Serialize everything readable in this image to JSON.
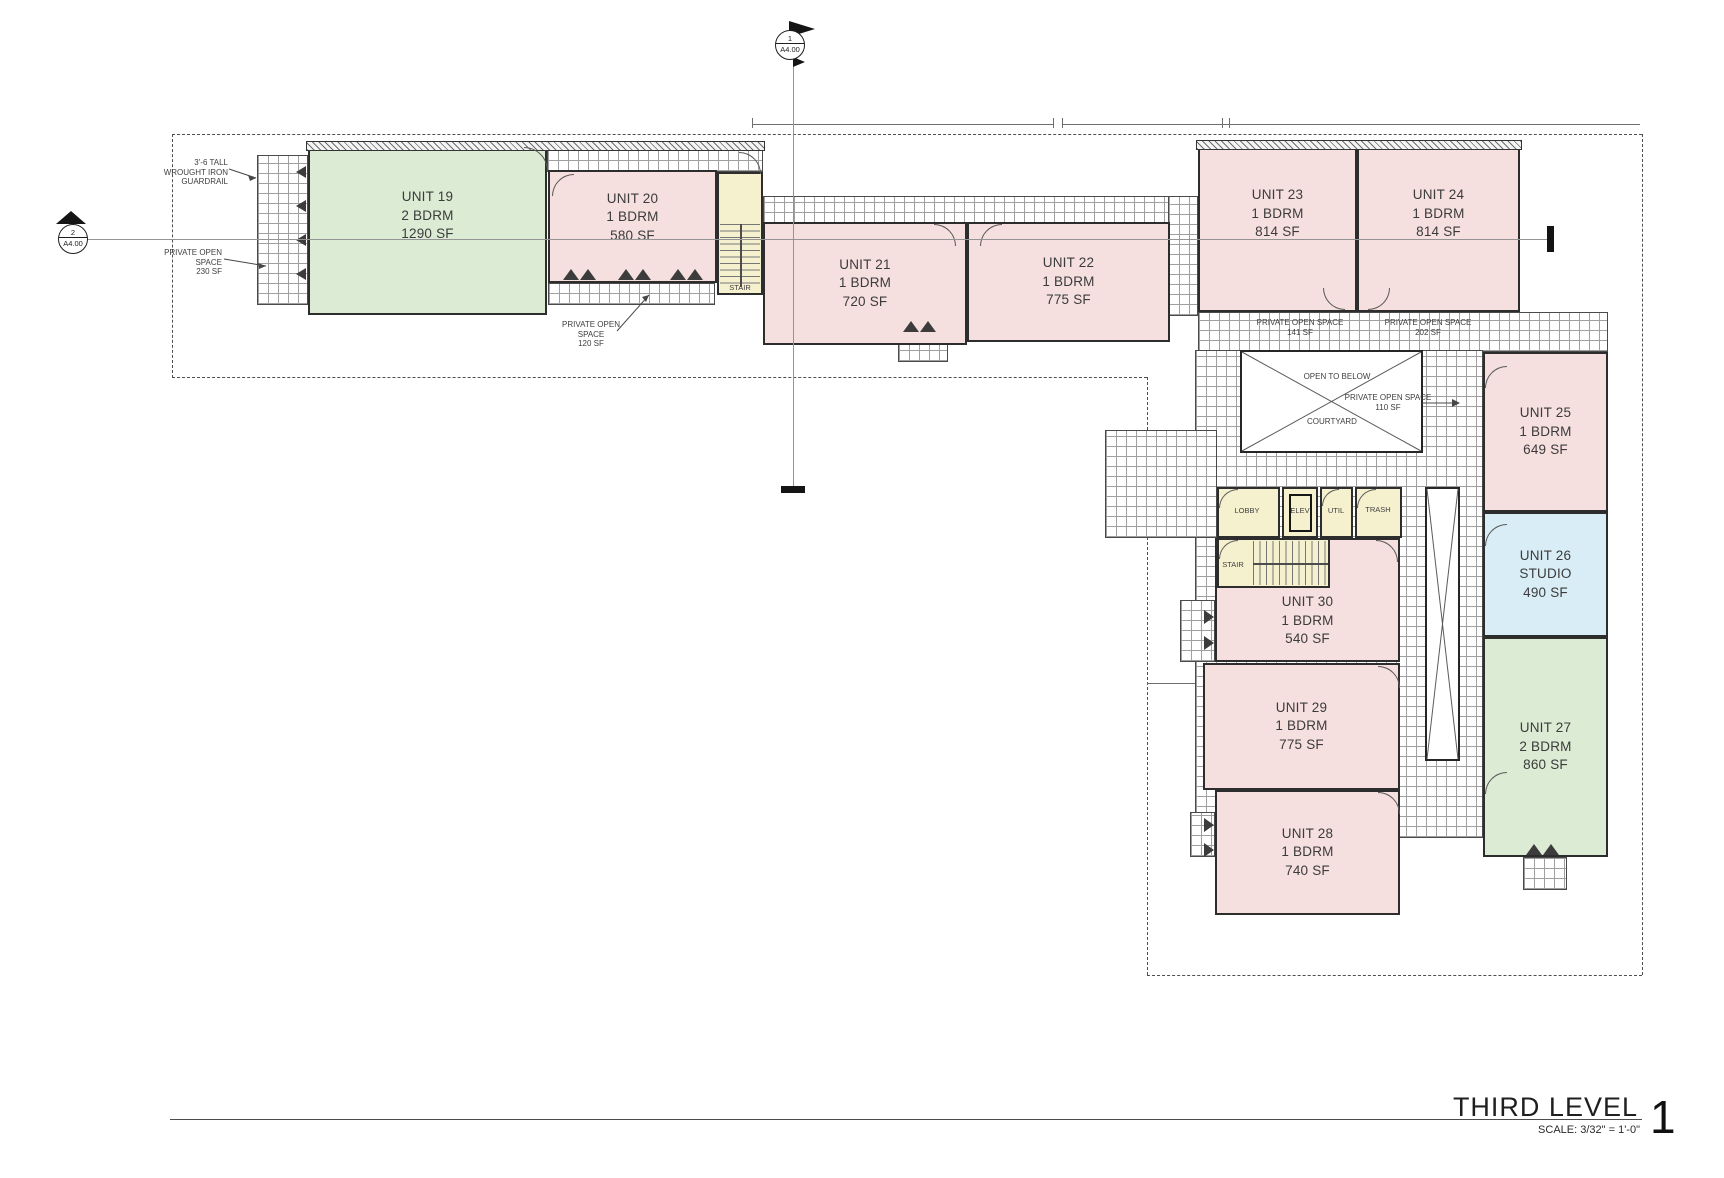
{
  "title_block": {
    "title": "THIRD LEVEL",
    "scale": "SCALE: 3/32\" = 1'-0\"",
    "number": "1"
  },
  "markers": {
    "top": {
      "num": "1",
      "sheet": "A4.00"
    },
    "left": {
      "num": "2",
      "sheet": "A4.00"
    }
  },
  "units": [
    {
      "name": "UNIT 19",
      "bed": "2 BDRM",
      "sf": "1290 SF"
    },
    {
      "name": "UNIT 20",
      "bed": "1 BDRM",
      "sf": "580 SF"
    },
    {
      "name": "UNIT 21",
      "bed": "1 BDRM",
      "sf": "720 SF"
    },
    {
      "name": "UNIT 22",
      "bed": "1 BDRM",
      "sf": "775 SF"
    },
    {
      "name": "UNIT 23",
      "bed": "1 BDRM",
      "sf": "814 SF"
    },
    {
      "name": "UNIT 24",
      "bed": "1 BDRM",
      "sf": "814 SF"
    },
    {
      "name": "UNIT 25",
      "bed": "1 BDRM",
      "sf": "649 SF"
    },
    {
      "name": "UNIT 26",
      "bed": "STUDIO",
      "sf": "490 SF"
    },
    {
      "name": "UNIT 27",
      "bed": "2 BDRM",
      "sf": "860 SF"
    },
    {
      "name": "UNIT 28",
      "bed": "1 BDRM",
      "sf": "740 SF"
    },
    {
      "name": "UNIT 29",
      "bed": "1 BDRM",
      "sf": "775 SF"
    },
    {
      "name": "UNIT 30",
      "bed": "1 BDRM",
      "sf": "540 SF"
    }
  ],
  "rooms": {
    "stair_upper": "STAIR",
    "stair_lower": "STAIR",
    "lobby": "LOBBY",
    "elev": "ELEV",
    "util": "UTIL",
    "trash": "TRASH"
  },
  "annotations": {
    "guardrail": {
      "l1": "3'-6 TALL",
      "l2": "WROUGHT IRON",
      "l3": "GUARDRAIL"
    },
    "pos230": {
      "l1": "PRIVATE OPEN",
      "l2": "SPACE",
      "l3": "230 SF"
    },
    "pos120": {
      "l1": "PRIVATE OPEN",
      "l2": "SPACE",
      "l3": "120 SF"
    },
    "pos141": {
      "l1": "PRIVATE OPEN SPACE",
      "l2": "141 SF"
    },
    "pos202": {
      "l1": "PRIVATE OPEN SPACE",
      "l2": "202 SF"
    },
    "pos110": {
      "l1": "PRIVATE OPEN SPACE",
      "l2": "110 SF"
    },
    "open_to_below": "OPEN TO BELOW",
    "courtyard": "COURTYARD"
  },
  "colors": {
    "unit_pink_1bdrm": "#f6dfdf",
    "unit_green_2bdrm": "#dcebd4",
    "unit_blue_studio": "#d8edf6",
    "service_yellow": "#f5f1cf",
    "wall": "#2d2d2d",
    "section_line": "#949494"
  }
}
